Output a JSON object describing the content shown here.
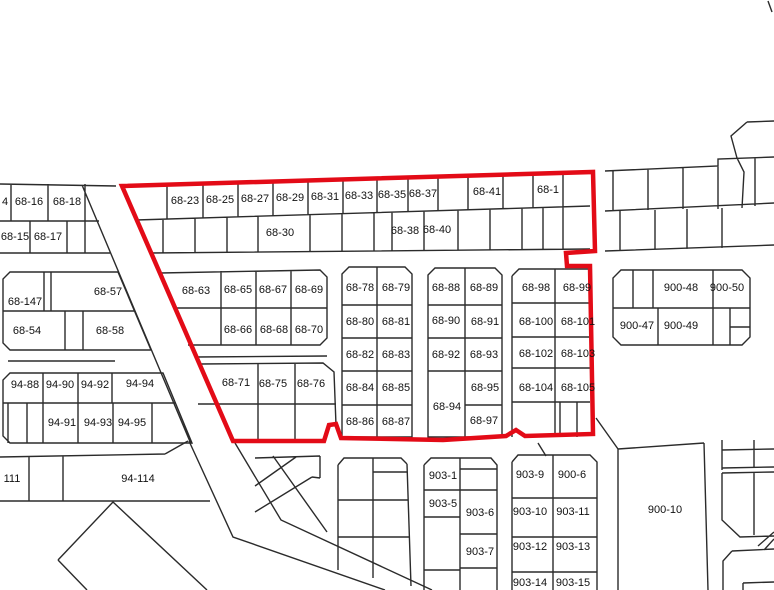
{
  "map": {
    "colors": {
      "background": "#ffffff",
      "parcel_line": "#2b2b2b",
      "label_text": "#111111",
      "highlight_boundary": "#e30b17"
    },
    "blocks": [
      {
        "name": "top-left-upper-row",
        "parcels": [
          {
            "label": "4",
            "x": 5,
            "y": 202
          },
          {
            "label": "68-16",
            "x": 29,
            "y": 202
          },
          {
            "label": "68-18",
            "x": 67,
            "y": 202
          }
        ]
      },
      {
        "name": "top-left-lower-row",
        "parcels": [
          {
            "label": "68-15",
            "x": 15,
            "y": 237
          },
          {
            "label": "68-17",
            "x": 48,
            "y": 237
          }
        ]
      },
      {
        "name": "west-block",
        "parcels": [
          {
            "label": "68-147",
            "x": 25,
            "y": 302
          },
          {
            "label": "68-57",
            "x": 108,
            "y": 292
          },
          {
            "label": "68-54",
            "x": 27,
            "y": 331
          },
          {
            "label": "68-58",
            "x": 110,
            "y": 331
          }
        ]
      },
      {
        "name": "southwest-block",
        "parcels": [
          {
            "label": "94-88",
            "x": 25,
            "y": 385
          },
          {
            "label": "94-90",
            "x": 60,
            "y": 385
          },
          {
            "label": "94-92",
            "x": 95,
            "y": 385
          },
          {
            "label": "94-94",
            "x": 140,
            "y": 384
          },
          {
            "label": "94-91",
            "x": 62,
            "y": 423
          },
          {
            "label": "94-93",
            "x": 98,
            "y": 423
          },
          {
            "label": "94-95",
            "x": 132,
            "y": 423
          }
        ]
      },
      {
        "name": "southwest-road-strip",
        "parcels": [
          {
            "label": "111",
            "x": 12,
            "y": 479
          },
          {
            "label": "94-114",
            "x": 138,
            "y": 479
          }
        ]
      },
      {
        "name": "north-strip-row-1",
        "parcels": [
          {
            "label": "68-23",
            "x": 185,
            "y": 201
          },
          {
            "label": "68-25",
            "x": 220,
            "y": 200
          },
          {
            "label": "68-27",
            "x": 255,
            "y": 199
          },
          {
            "label": "68-29",
            "x": 290,
            "y": 198
          },
          {
            "label": "68-31",
            "x": 325,
            "y": 197
          },
          {
            "label": "68-33",
            "x": 359,
            "y": 196
          },
          {
            "label": "68-35",
            "x": 392,
            "y": 195
          },
          {
            "label": "68-37",
            "x": 423,
            "y": 194
          },
          {
            "label": "68-41",
            "x": 487,
            "y": 192
          },
          {
            "label": "68-1",
            "x": 548,
            "y": 190
          }
        ]
      },
      {
        "name": "north-strip-row-2",
        "parcels": [
          {
            "label": "68-30",
            "x": 280,
            "y": 233
          },
          {
            "label": "68-38",
            "x": 405,
            "y": 231
          },
          {
            "label": "68-40",
            "x": 437,
            "y": 230
          }
        ]
      },
      {
        "name": "block-68-63",
        "parcels": [
          {
            "label": "68-63",
            "x": 196,
            "y": 291
          },
          {
            "label": "68-65",
            "x": 238,
            "y": 290
          },
          {
            "label": "68-67",
            "x": 273,
            "y": 290
          },
          {
            "label": "68-69",
            "x": 309,
            "y": 290
          },
          {
            "label": "68-66",
            "x": 238,
            "y": 330
          },
          {
            "label": "68-68",
            "x": 274,
            "y": 330
          },
          {
            "label": "68-70",
            "x": 309,
            "y": 330
          }
        ]
      },
      {
        "name": "block-68-71",
        "parcels": [
          {
            "label": "68-71",
            "x": 236,
            "y": 383
          },
          {
            "label": "68-75",
            "x": 273,
            "y": 384
          },
          {
            "label": "68-76",
            "x": 311,
            "y": 384
          }
        ]
      },
      {
        "name": "block-68-78",
        "parcels": [
          {
            "label": "68-78",
            "x": 360,
            "y": 288
          },
          {
            "label": "68-79",
            "x": 396,
            "y": 288
          },
          {
            "label": "68-80",
            "x": 360,
            "y": 322
          },
          {
            "label": "68-81",
            "x": 396,
            "y": 322
          },
          {
            "label": "68-82",
            "x": 360,
            "y": 355
          },
          {
            "label": "68-83",
            "x": 396,
            "y": 355
          },
          {
            "label": "68-84",
            "x": 360,
            "y": 388
          },
          {
            "label": "68-85",
            "x": 396,
            "y": 388
          },
          {
            "label": "68-86",
            "x": 360,
            "y": 422
          },
          {
            "label": "68-87",
            "x": 396,
            "y": 422
          }
        ]
      },
      {
        "name": "block-68-88",
        "parcels": [
          {
            "label": "68-88",
            "x": 446,
            "y": 288
          },
          {
            "label": "68-89",
            "x": 484,
            "y": 288
          },
          {
            "label": "68-90",
            "x": 446,
            "y": 321
          },
          {
            "label": "68-91",
            "x": 485,
            "y": 322
          },
          {
            "label": "68-92",
            "x": 446,
            "y": 355
          },
          {
            "label": "68-93",
            "x": 484,
            "y": 355
          },
          {
            "label": "68-95",
            "x": 485,
            "y": 388
          },
          {
            "label": "68-94",
            "x": 447,
            "y": 407
          },
          {
            "label": "68-97",
            "x": 484,
            "y": 421
          }
        ]
      },
      {
        "name": "block-68-98",
        "parcels": [
          {
            "label": "68-98",
            "x": 536,
            "y": 288
          },
          {
            "label": "68-99",
            "x": 577,
            "y": 288
          },
          {
            "label": "68-100",
            "x": 536,
            "y": 322
          },
          {
            "label": "68-101",
            "x": 578,
            "y": 322
          },
          {
            "label": "68-102",
            "x": 536,
            "y": 354
          },
          {
            "label": "68-103",
            "x": 578,
            "y": 354
          },
          {
            "label": "68-104",
            "x": 536,
            "y": 388
          },
          {
            "label": "68-105",
            "x": 578,
            "y": 388
          }
        ]
      },
      {
        "name": "block-900-48",
        "parcels": [
          {
            "label": "900-48",
            "x": 681,
            "y": 288
          },
          {
            "label": "900-50",
            "x": 727,
            "y": 288
          },
          {
            "label": "900-47",
            "x": 637,
            "y": 326
          },
          {
            "label": "900-49",
            "x": 681,
            "y": 326
          }
        ]
      },
      {
        "name": "block-903-west",
        "parcels": [
          {
            "label": "903-1",
            "x": 443,
            "y": 476
          },
          {
            "label": "903-5",
            "x": 443,
            "y": 504
          },
          {
            "label": "903-6",
            "x": 480,
            "y": 513
          },
          {
            "label": "903-7",
            "x": 480,
            "y": 552
          }
        ]
      },
      {
        "name": "block-903-east",
        "parcels": [
          {
            "label": "903-9",
            "x": 530,
            "y": 475
          },
          {
            "label": "900-6",
            "x": 572,
            "y": 475
          },
          {
            "label": "903-10",
            "x": 530,
            "y": 512
          },
          {
            "label": "903-11",
            "x": 573,
            "y": 512
          },
          {
            "label": "903-12",
            "x": 530,
            "y": 547
          },
          {
            "label": "903-13",
            "x": 573,
            "y": 547
          },
          {
            "label": "903-14",
            "x": 530,
            "y": 583
          },
          {
            "label": "903-15",
            "x": 573,
            "y": 583
          }
        ]
      },
      {
        "name": "block-900-10",
        "parcels": [
          {
            "label": "900-10",
            "x": 665,
            "y": 510
          }
        ]
      }
    ]
  }
}
